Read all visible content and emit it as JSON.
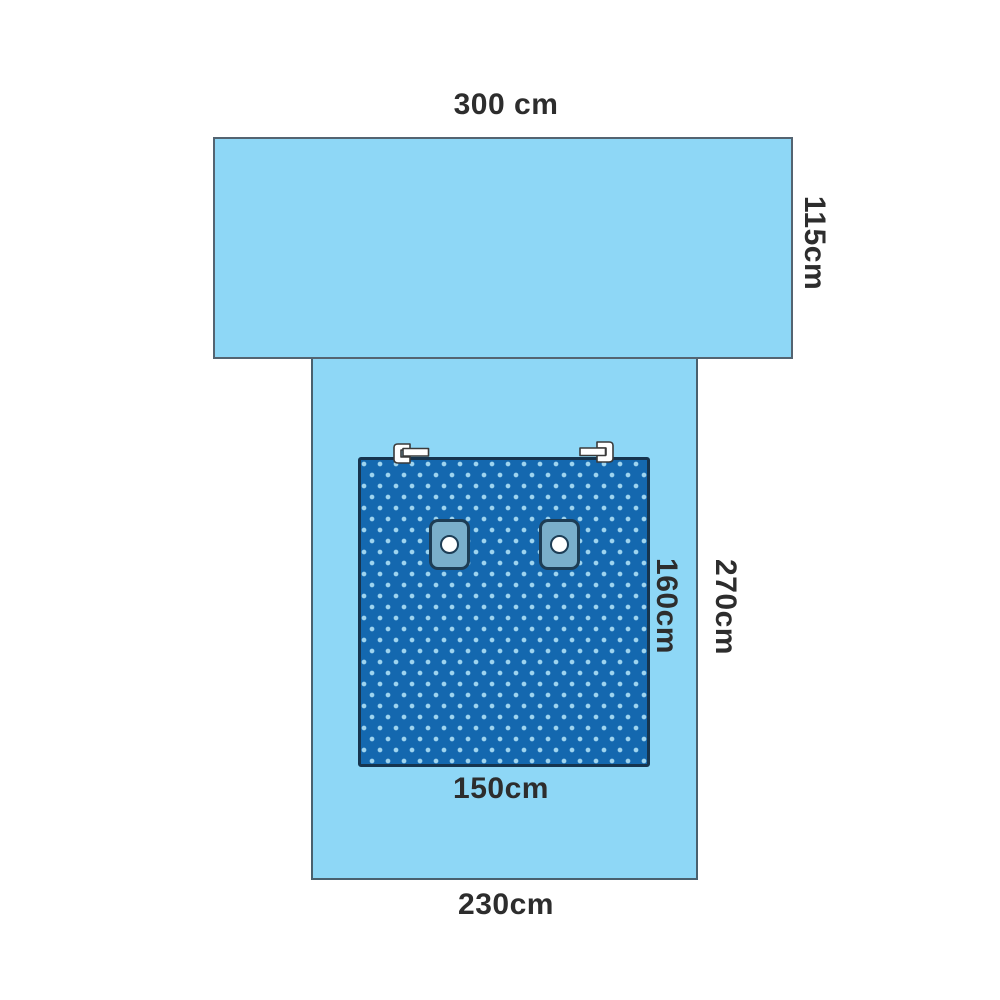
{
  "diagram": {
    "description": "Surgical drape dimensional diagram with reinforced dotted panel, two adhesive patches with holes, and two tube-holder clips",
    "labels": {
      "top_width": "300 cm",
      "top_height": "115cm",
      "panel_height": "160cm",
      "body_height": "270cm",
      "panel_width": "150cm",
      "body_width": "230cm"
    },
    "dimensions_cm": {
      "top_sheet": {
        "width": 300,
        "height": 115
      },
      "body": {
        "width": 230,
        "height": 270
      },
      "reinforced_panel": {
        "width": 150,
        "height": 160
      }
    },
    "colors": {
      "background": "#ffffff",
      "drape_fill": "#8ed7f6",
      "drape_border": "#4e6170",
      "panel_fill": "#1468af",
      "panel_dots": "#9ed4ef",
      "panel_border": "#16344e",
      "patch_fill": "#7aafcb",
      "patch_border": "#1d3d55",
      "patch_hole": "#ffffff",
      "clip_fill": "#ffffff",
      "clip_border": "#3a3a3a",
      "label_text": "#2d2d2d"
    }
  }
}
